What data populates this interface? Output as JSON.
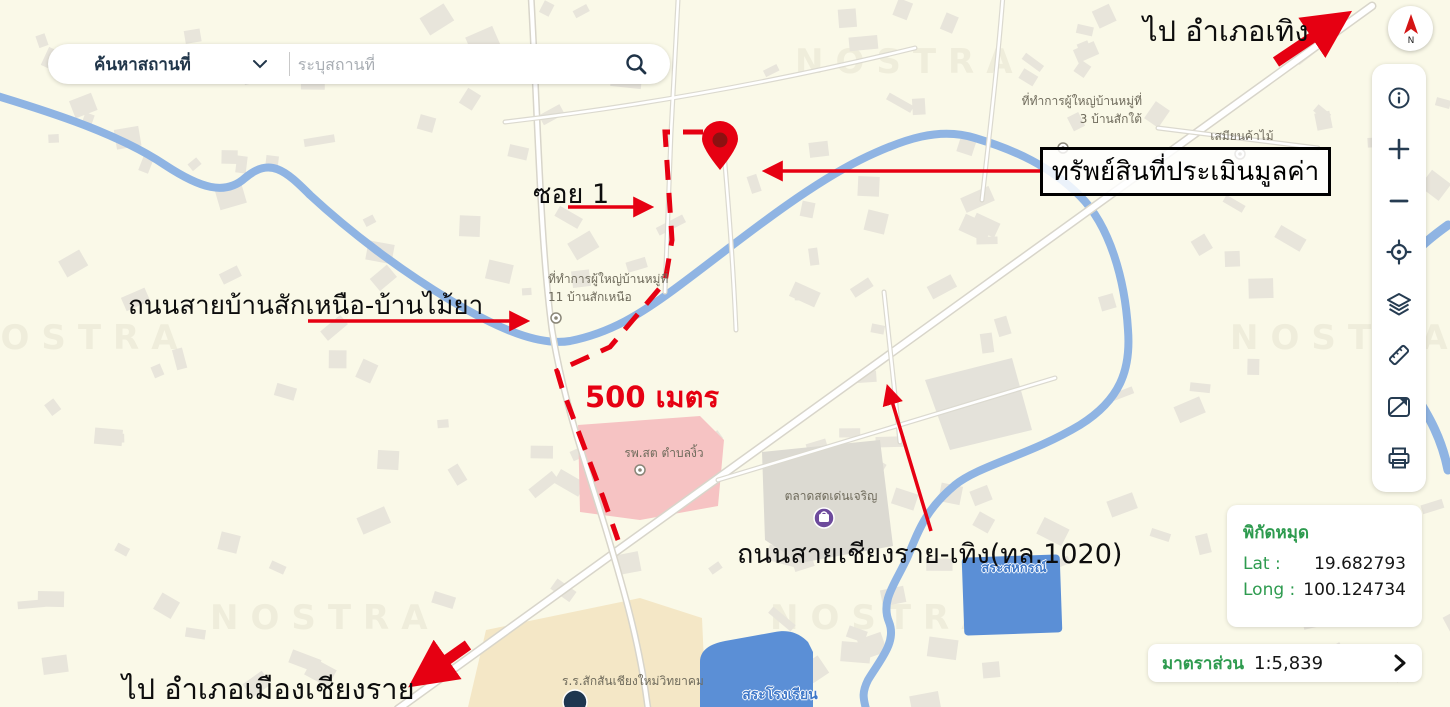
{
  "search": {
    "category_label": "ค้นหาสถานที่",
    "placeholder": "ระบุสถานที่"
  },
  "compass": {
    "north_label": "N"
  },
  "toolbar": {
    "icons": [
      "info",
      "zoom-in",
      "zoom-out",
      "locate",
      "layers",
      "measure",
      "basemap",
      "print"
    ]
  },
  "annotations": {
    "to_thoeng": "ไป อำเภอเทิง",
    "property_box": "ทรัพย์สินที่ประเมินมูลค่า",
    "soi": "ซอย 1",
    "road_bansak": "ถนนสายบ้านสักเหนือ-บ้านไม้ยา",
    "distance": "500 เมตร",
    "road_chiangrai_thoeng": "ถนนสายเชียงราย-เทิง(ทล.1020)",
    "to_mueang_chiangrai": "ไป อำเภอเมืองเชียงราย"
  },
  "map_labels": {
    "village_office_3_line1": "ที่ทำการผู้ใหญ่บ้านหมู่ที่",
    "village_office_3_line2": "3 บ้านสักใต้",
    "sawmill": "เสมียนค้าไม้",
    "village_office_11_line1": "ที่ทำการผู้ใหญ่บ้านหมู่ที่",
    "village_office_11_line2": "11 บ้านสักเหนือ",
    "health_center": "รพ.สต ตำบลงิ้ว",
    "market": "ตลาดสดเด่นเจริญ",
    "coop_pond": "สระสหกรณ์",
    "school": "ร.ร.สักสันเชียงใหม่วิทยาคม",
    "school_pond": "สระโรงเรียน",
    "watermark": "NOSTRA"
  },
  "coordinates_panel": {
    "title": "พิกัดหมุด",
    "lat_label": "Lat :",
    "lat_value": "19.682793",
    "long_label": "Long :",
    "long_value": "100.124734"
  },
  "scale_bar": {
    "label": "มาตราส่วน",
    "value": "1:5,839"
  },
  "colors": {
    "annotation_red": "#e60012",
    "green": "#2e9b4f",
    "river": "#8fb4e3",
    "pond": "#5b8fd6",
    "icon_navy": "#263c52",
    "map_background": "#faf9e8"
  }
}
